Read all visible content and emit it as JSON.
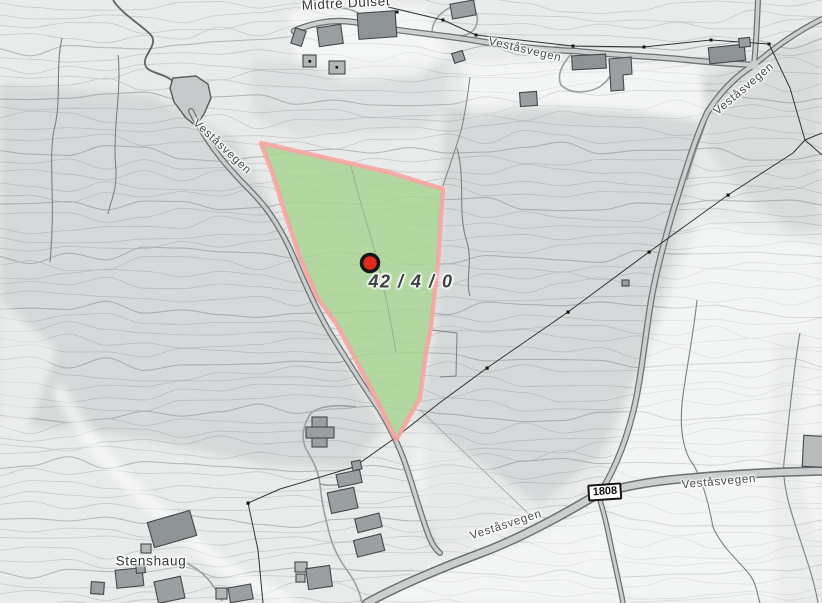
{
  "parcel": {
    "label": "42 / 4 / 0",
    "fill_color": "#aad496",
    "border_color": "#f7a5a2",
    "marker_color": "#e02a1e"
  },
  "places": {
    "farm": "Midtre Dulset",
    "hamlet": "Stenshaug"
  },
  "roads": {
    "name": "Veståsvegen",
    "number": "1808"
  },
  "terrain": {
    "contour_label_fragment": "1"
  }
}
